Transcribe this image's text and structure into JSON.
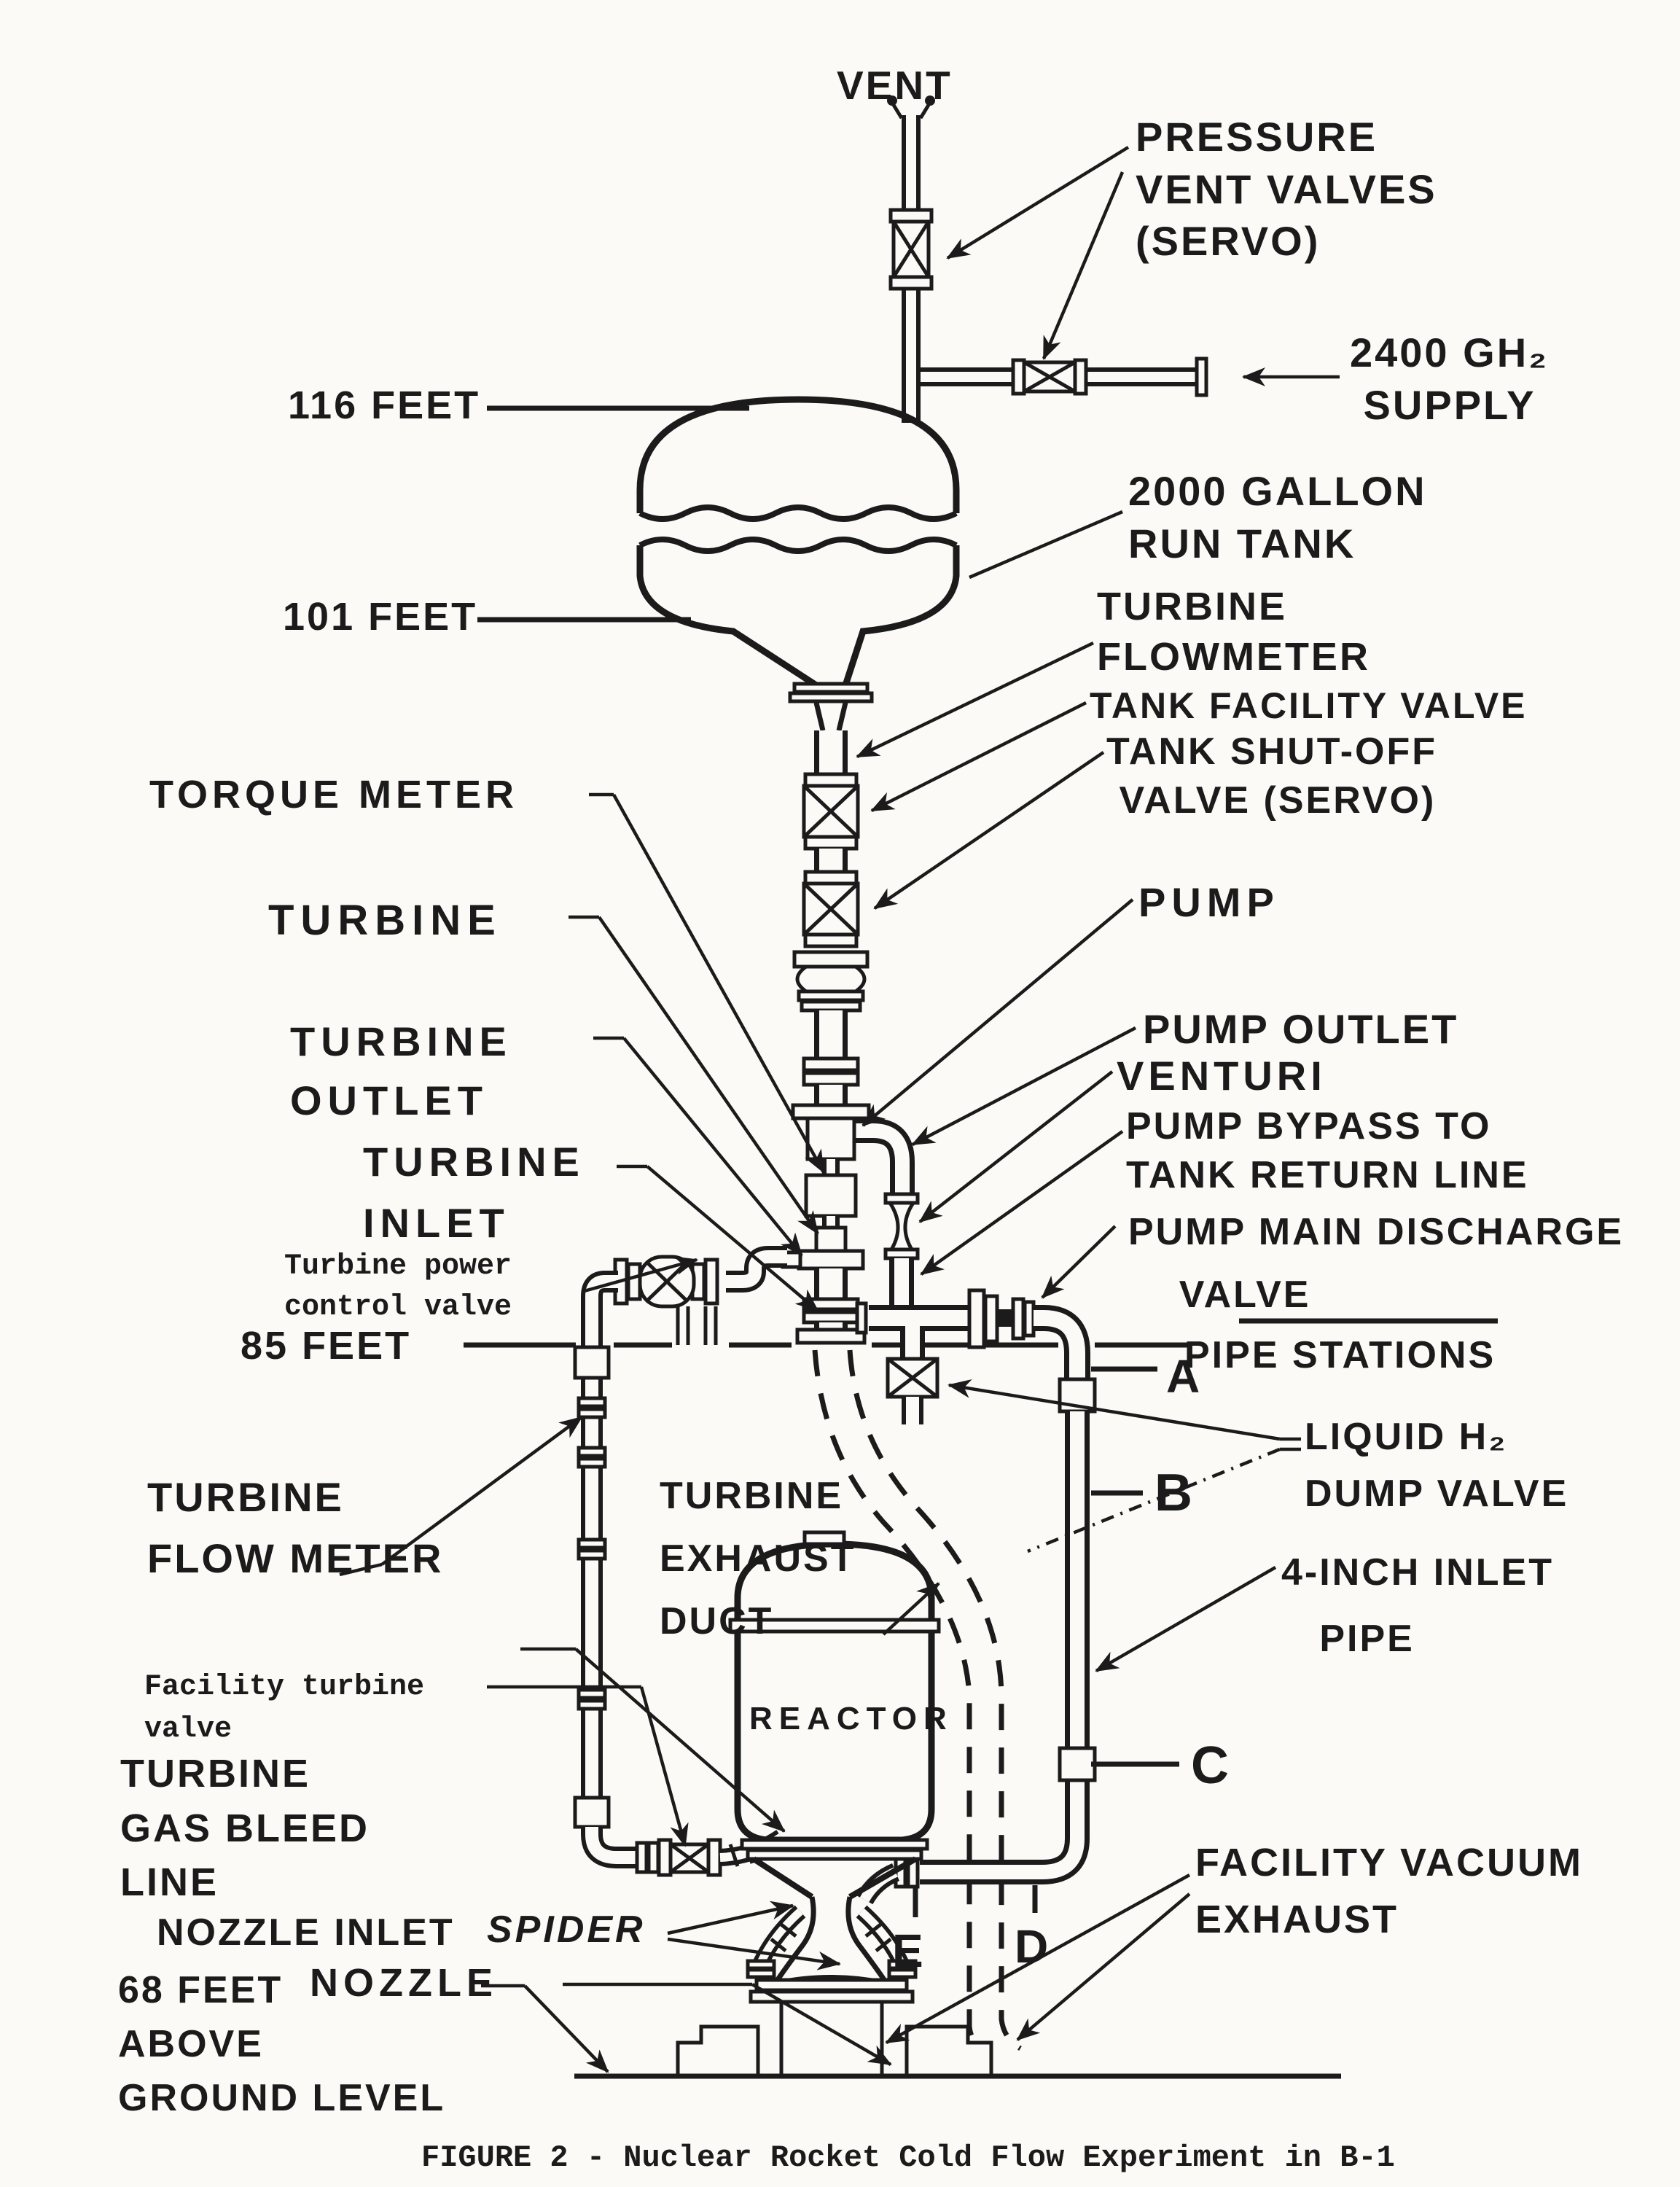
{
  "page": {
    "paper": "#fbfaf7",
    "ink": "#1b1b1b"
  },
  "caption": {
    "text": "FIGURE 2 - Nuclear Rocket Cold Flow Experiment in B-1"
  },
  "labels": {
    "vent": "VENT",
    "pressure_vent_valves": "PRESSURE\nVENT VALVES\n(SERVO)",
    "gh2_supply": "2400 GH₂\n SUPPLY",
    "feet_116": "116 FEET",
    "run_tank": "2000 GALLON\nRUN TANK",
    "feet_101": "101 FEET",
    "turbine_flowmeter_right": "TURBINE\nFLOWMETER",
    "tank_facility_valve": "TANK FACILITY VALVE",
    "tank_shutoff_valve": "TANK SHUT-OFF\n VALVE (SERVO)",
    "torque_meter": "TORQUE METER",
    "turbine": "TURBINE",
    "pump": "PUMP",
    "pump_outlet": "PUMP OUTLET",
    "turbine_outlet": "TURBINE\nOUTLET",
    "venturi": "VENTURI",
    "pump_bypass": "PUMP BYPASS TO\nTANK RETURN LINE",
    "turbine_inlet": "TURBINE\nINLET",
    "pump_main_discharge": "PUMP MAIN DISCHARGE\n    VALVE",
    "turbine_power_control_valve": "Turbine power\ncontrol valve",
    "feet_85": "85 FEET",
    "pipe_stations": "PIPE STATIONS",
    "station_a": "A",
    "station_b": "B",
    "station_c": "C",
    "station_d": "D",
    "station_e": "E",
    "liquid_h2_dump_valve": "LIQUID H₂\nDUMP VALVE",
    "turbine_flow_meter_left": "TURBINE\nFLOW METER",
    "turbine_exhaust_duct": "TURBINE\nEXHAUST\nDUCT",
    "four_inch_inlet_pipe": "4-INCH INLET\n   PIPE",
    "nozzle_bleed_port_line1": "NOZZLE",
    "nozzle_bleed_port_line2": "BLEED PORT",
    "facility_turbine_valve": "Facility turbine\nvalve",
    "turbine_gas_bleed_line": "TURBINE\nGAS BLEED\nLINE",
    "reactor": "REACTOR",
    "nozzle_inlet": "NOZZLE INLET",
    "spider": "SPIDER",
    "nozzle": "NOZZLE",
    "facility_vacuum_exhaust": "FACILITY VACUUM\nEXHAUST",
    "feet_68": "68 FEET\nABOVE\nGROUND LEVEL"
  }
}
